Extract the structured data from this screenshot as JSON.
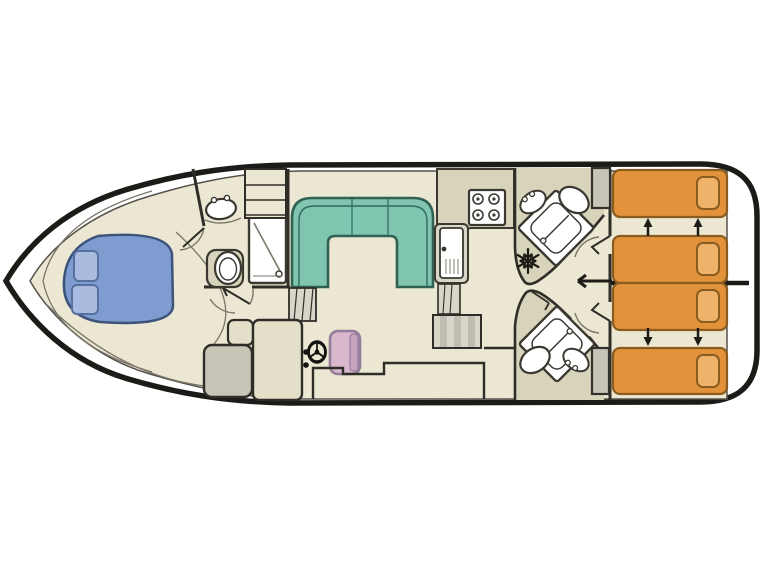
{
  "diagram": {
    "type": "boat-deck-floor-plan",
    "orientation": "bow-left-stern-right",
    "rooms": [
      {
        "name": "bow-cabin",
        "furniture": [
          "double-bed",
          "two-pillows"
        ]
      },
      {
        "name": "forward-bathroom",
        "furniture": [
          "sink",
          "toilet",
          "shower"
        ]
      },
      {
        "name": "saloon",
        "furniture": [
          "u-shaped-sofa",
          "companionway-ladder",
          "steps",
          "helm-console",
          "helm-seat",
          "steering-wheel",
          "side-seat"
        ]
      },
      {
        "name": "galley",
        "furniture": [
          "l-shaped-counter",
          "four-burner-stove",
          "sink-with-drainer",
          "fridge",
          "staircase"
        ]
      },
      {
        "name": "aft-bathroom-upper",
        "furniture": [
          "corner-shower",
          "sink",
          "toilet"
        ]
      },
      {
        "name": "aft-bathroom-lower",
        "furniture": [
          "corner-shower",
          "sink",
          "toilet"
        ]
      },
      {
        "name": "stern-cabin-upper",
        "furniture": [
          "single-bed",
          "single-bed",
          "wardrobe"
        ]
      },
      {
        "name": "stern-cabin-lower",
        "furniture": [
          "single-bed",
          "single-bed",
          "wardrobe"
        ]
      }
    ],
    "icons": [
      "snowflake-fridge-icon",
      "steering-wheel-icon",
      "stove-burner-icon",
      "shower-icon",
      "toilet-icon",
      "sink-icon",
      "bed-slide-arrow-icon",
      "door-swing-icon",
      "ladder-icon"
    ],
    "bed_slide_arrows": {
      "upper_cabin_direction": "up",
      "lower_cabin_direction": "down",
      "count_per_cabin": 2
    }
  },
  "colors": {
    "page_bg": "#ffffff",
    "deck_white": "#ffffff",
    "hull_outline": "#1c1b17",
    "floor": "#ebe7d2",
    "floor_dark": "#d8d4bb",
    "wall": "#2f2d27",
    "bow_bed": "#7e9cd0",
    "bow_pillow": "#a9bcdf",
    "sofa": "#7fc5b0",
    "sofa_line": "#2f6b5c",
    "stern_bed": "#e2923b",
    "stern_pillow": "#eeb26b",
    "bed_outline": "#8a5c20",
    "helm_seat": "#d9b7cd",
    "helm_seat_dark": "#c9a2bd",
    "cabinet_gray": "#c7c5b7",
    "cabinet_tan": "#e3dfc9",
    "steps_light": "#d8d6c8",
    "steps_dark": "#bfbdaf",
    "arrow": "#1d1b16"
  }
}
